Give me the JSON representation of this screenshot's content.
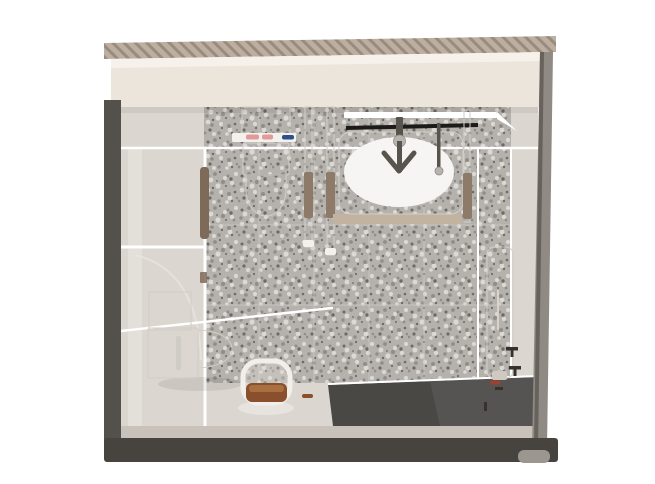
{
  "scene": {
    "type": "3d-architectural-render",
    "view": "top-down plan view",
    "subject": "prefabricated unit bathroom pod",
    "objects": [
      "sectioned pod walls with hatched cut edge",
      "terrazzo tiled back wall and floor",
      "wall-hung toilet with toiletry shelf",
      "countertop wash basin with dark faucet",
      "mirror shelf and black towel bar",
      "floor-to-ceiling grab poles with wooden grips",
      "glass shower partitions",
      "wooden glass-door handle",
      "wall-mounted water heater panel",
      "towel hooks",
      "second toilet with cistern cabinet",
      "shower stool with wooden seat",
      "dark recessed floor tray",
      "pod support foot"
    ]
  },
  "colors": {
    "background": "#ffffff",
    "wall_hatch_base": "#bcafa1",
    "wall_hatch_stripe": "#9a8c7d",
    "wall_top_face": "#ece5dc",
    "wall_top_light": "#f6f1ea",
    "wall_dark": "#54504c",
    "wall_bottom": "#474440",
    "wall_inner_band": "#c9c2ba",
    "wall_right": "#8f8a84",
    "wall_right_edge": "#5c5853",
    "foot_gray": "#9b968f",
    "floor_light": "#dbd6cf",
    "terrazzo_base": "#b5b2ad",
    "speck_dark": "#6e6a65",
    "speck_mid": "#918d88",
    "speck_light": "#dcd9d4",
    "tile_line": "#cfccc7",
    "glass_white": "#ffffff",
    "fixture_white": "#e7e4e0",
    "shelf_white": "#f3f1ee",
    "pole_white": "#ece9e5",
    "wood_brown": "#8d7a68",
    "handle_brown": "#7e6a58",
    "basin_white": "#edebe8",
    "basin_inner": "#f6f5f3",
    "counter_tan": "#c2b2a0",
    "faucet_dark": "#57534d",
    "black_bar": "#1d1b19",
    "item_pink": "#e09a9a",
    "item_blue": "#2f4f88",
    "heater_white": "#f6f4f1",
    "hook_dark": "#35312d",
    "accent_red": "#a33f2a",
    "floor_dark": "#4a4845",
    "seat_wood": "#8a4f2c",
    "seat_wood_light": "#a96f3f",
    "stool_white": "#f2efeb"
  }
}
